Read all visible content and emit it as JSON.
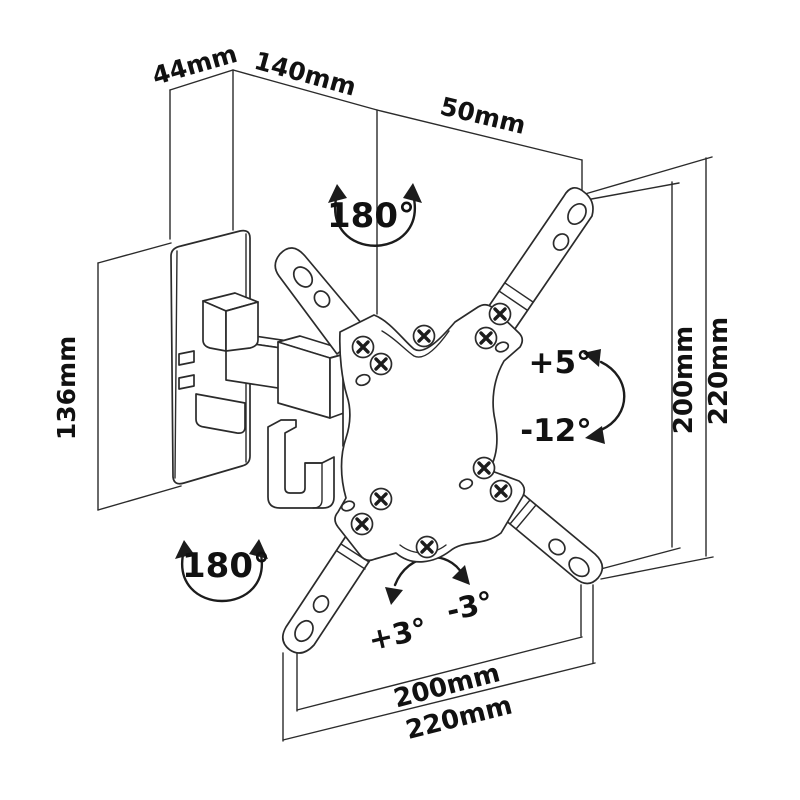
{
  "title": "TV wall mount bracket dimensional line drawing",
  "colors": {
    "background": "#ffffff",
    "line": "#2b2b2b",
    "text": "#111111"
  },
  "dimensions": {
    "wall_plate_width": "44mm",
    "arm_reach": "140mm",
    "bracket_depth": "50mm",
    "wall_plate_height": "136mm",
    "vesa_right_inner": "200mm",
    "vesa_right_outer": "220mm",
    "vesa_bottom_inner": "200mm",
    "vesa_bottom_outer": "220mm"
  },
  "angles": {
    "swivel_top": "180°",
    "swivel_bottom": "180°",
    "tilt_up": "+5°",
    "tilt_down": "-12°",
    "rotate_plus": "+3°",
    "rotate_minus": "-3°"
  }
}
